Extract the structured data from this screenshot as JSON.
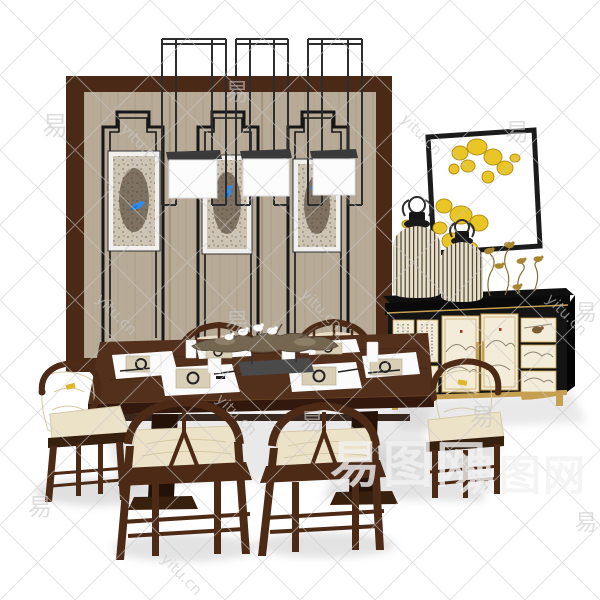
{
  "page": {
    "background": "#ffffff",
    "kind": "3d furniture render of a chinese style dining room set"
  },
  "watermark": {
    "url_text": "yitu.cn",
    "char": "易",
    "site_name": "易图网"
  },
  "colors": {
    "background": "#ffffff",
    "screen_frame": "#4a2a17",
    "screen_panel": "#b7aa97",
    "screen_grain": "#a29074",
    "screen_line": "#171717",
    "art_frame": "#f2f0ec",
    "art_paper": "#cdc4b4",
    "art_ink": "#4a3a2c",
    "bird_blue": "#2f8be6",
    "metal_black": "#2d2d2d",
    "shade_top": "#3a3a3a",
    "shade_white": "#fcfcfc",
    "gold_leaf": "#e9c526",
    "gold_leaf_edge": "#b5921a",
    "cabinet_black": "#141414",
    "cabinet_panel": "#f3ecd9",
    "gold_trim": "#c6a050",
    "painting_ink": "#8f8672",
    "seal_red": "#b03a2a",
    "lantern_body": "#e9dfc7",
    "lantern_line": "#2f2b24",
    "decor_gold": "#a8862f",
    "decor_gold_dark": "#8a6d35",
    "table_wood": "#53301c",
    "table_edge": "#33190d",
    "table_base": "#241208",
    "chair_wood": "#4c2a15",
    "chair_wood_dark": "#38200e",
    "cushion": "#ece2c8",
    "cushion_shade": "#d6c9a6",
    "mat_white": "#fbfbfb",
    "plate_beige": "#d9cfb6",
    "ink_dark": "#222222",
    "branch_wood": "#756651",
    "branch_dark": "#5d5142",
    "dove_white": "#ffffff",
    "stand_gray": "#4a4a4a",
    "shadow": "#c7c7c7",
    "accent_yellow": "#e0b528",
    "wm_gray": "#c9c9c9",
    "wm_light": "#f2f2f2"
  },
  "scene": {
    "items": [
      {
        "id": "folding-screen",
        "label": "dark wood folding screen with beige fabric panels and black stepped line motifs"
      },
      {
        "id": "screen-artworks",
        "label": "three framed abstract artworks with blue bird motifs"
      },
      {
        "id": "pendant-lights",
        "label": "three black metal cage pendant lights with white box shades"
      },
      {
        "id": "gold-leaf-wall-art",
        "label": "black framed wall art with gold leaf petals"
      },
      {
        "id": "sideboard",
        "label": "black and gold sideboard with painted landscape panels"
      },
      {
        "id": "lantern-vases",
        "label": "two striped birdcage style vases"
      },
      {
        "id": "gold-bird-decor",
        "label": "gold birds on wire stems"
      },
      {
        "id": "dining-table",
        "label": "dark wood dining table with double pedestal base"
      },
      {
        "id": "armchairs",
        "label": "two horseshoe back armchairs with cream cushions"
      },
      {
        "id": "wishbone-chairs",
        "label": "wishbone side chairs with cream cushions"
      },
      {
        "id": "place-settings",
        "label": "six place settings with white mats, plates, cups and chopsticks"
      },
      {
        "id": "centerpiece",
        "label": "driftwood branch centerpiece with white doves on a gray stand"
      }
    ]
  }
}
